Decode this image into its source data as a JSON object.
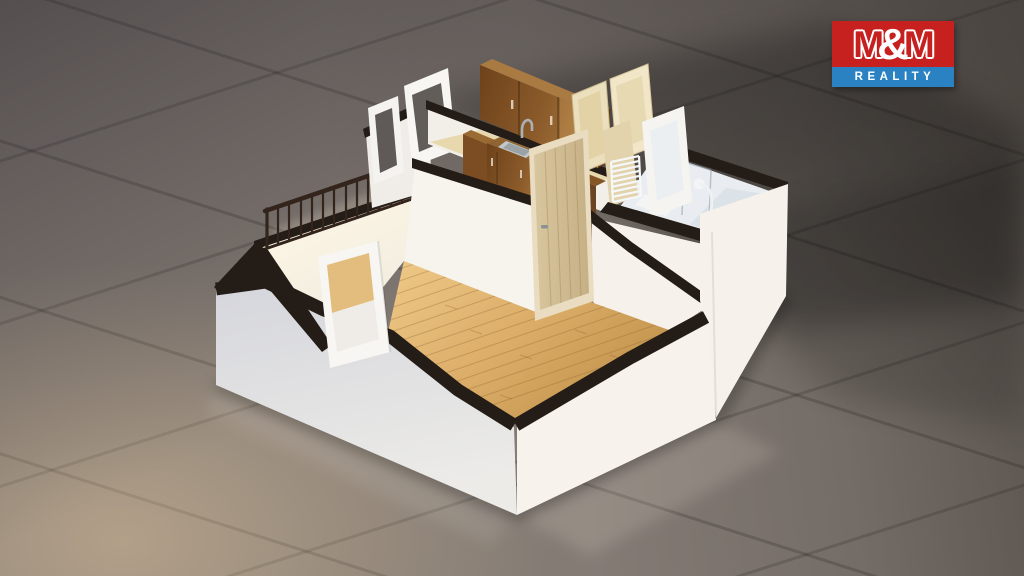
{
  "watermark": {
    "m_left": "M",
    "amp": "&",
    "m_right": "M",
    "brand_bottom": "REALITY"
  },
  "palette": {
    "tile-base": "#837b74",
    "wall-bright": "#f6f2eb",
    "wall-shaded": "#dcdde2",
    "cut-dark": "#241c16",
    "parquet-light": "#eec584",
    "parquet-dark": "#c49147",
    "cabinet-wood": "#7c4d20",
    "cabinet-wood-top": "#a97b42",
    "cabinet-wood-side": "#5f3a18",
    "door-wood": "#d2bd92",
    "cream-door": "#ecdfbd",
    "bath-interior": "#e9edf1",
    "landing-floor": "#fff6e2",
    "railing": "#33241c",
    "logo-red": "#c6201f",
    "logo-blue": "#2b82c3"
  },
  "scene": {
    "type": "3d-cutaway-floor-plan-render",
    "objects": [
      "tile-floor",
      "stair-landing",
      "stair-railing",
      "roof-window-frame",
      "roof-window-frame",
      "kitchen-upper-cabinets",
      "kitchen-sink",
      "kitchen-faucet",
      "kitchen-base-cabinets",
      "cream-door",
      "cream-door",
      "towel-radiator",
      "bathroom",
      "shower-head",
      "shower-glass",
      "interior-door",
      "parquet-floor",
      "knee-wall-window-frame"
    ]
  }
}
